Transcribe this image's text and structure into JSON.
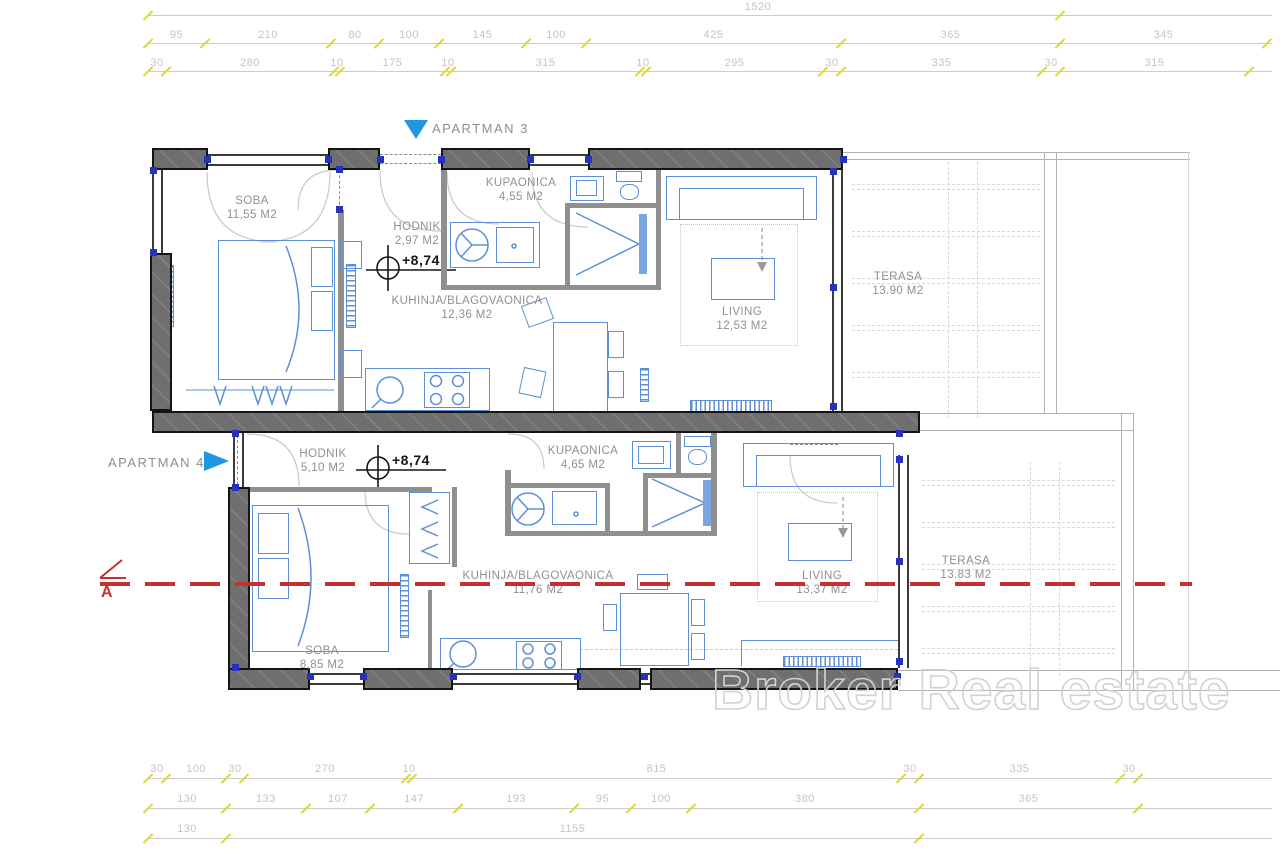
{
  "apartments": [
    {
      "name": "APARTMAN 3",
      "elevation": "+8,74",
      "rooms": [
        {
          "name": "SOBA",
          "area": "11,55 M2"
        },
        {
          "name": "HODNIK",
          "area": "2,97 M2"
        },
        {
          "name": "KUPAONICA",
          "area": "4,55 M2"
        },
        {
          "name": "KUHINJA/BLAGOVAONICA",
          "area": "12,36 M2"
        },
        {
          "name": "LIVING",
          "area": "12,53 M2"
        },
        {
          "name": "TERASA",
          "area": "13.90 M2"
        }
      ]
    },
    {
      "name": "APARTMAN 4",
      "elevation": "+8,74",
      "rooms": [
        {
          "name": "HODNIK",
          "area": "5,10 M2"
        },
        {
          "name": "KUPAONICA",
          "area": "4,65 M2"
        },
        {
          "name": "KUHINJA/BLAGOVAONICA",
          "area": "11,76 M2"
        },
        {
          "name": "LIVING",
          "area": "13,37 M2"
        },
        {
          "name": "SOBA",
          "area": "8,85 M2"
        },
        {
          "name": "TERASA",
          "area": "13.83 M2"
        }
      ]
    }
  ],
  "section": {
    "label": "A"
  },
  "watermark": "Broker Real estate",
  "dimensions": {
    "top": [
      [
        "1520"
      ],
      [
        "95",
        "210",
        "80",
        "100",
        "145",
        "100",
        "425",
        "365",
        "345"
      ],
      [
        "30",
        "280",
        "10",
        "175",
        "10",
        "315",
        "10",
        "295",
        "30",
        "335",
        "30",
        "315"
      ]
    ],
    "bottom": [
      [
        "30",
        "100",
        "30",
        "270",
        "10",
        "815",
        "30",
        "335",
        "30"
      ],
      [
        "130",
        "133",
        "107",
        "147",
        "193",
        "95",
        "100",
        "380",
        "365"
      ],
      [
        "130",
        "1155"
      ]
    ]
  },
  "colors": {
    "accent_blue": "#2196e0",
    "furniture_blue": "#5d8fd6",
    "wall_gray": "#6f6f6f",
    "dimension_text": "#c4c4c4",
    "tick_yellow": "#ddd92a",
    "section_red": "#c53030",
    "label_gray": "#909090"
  }
}
